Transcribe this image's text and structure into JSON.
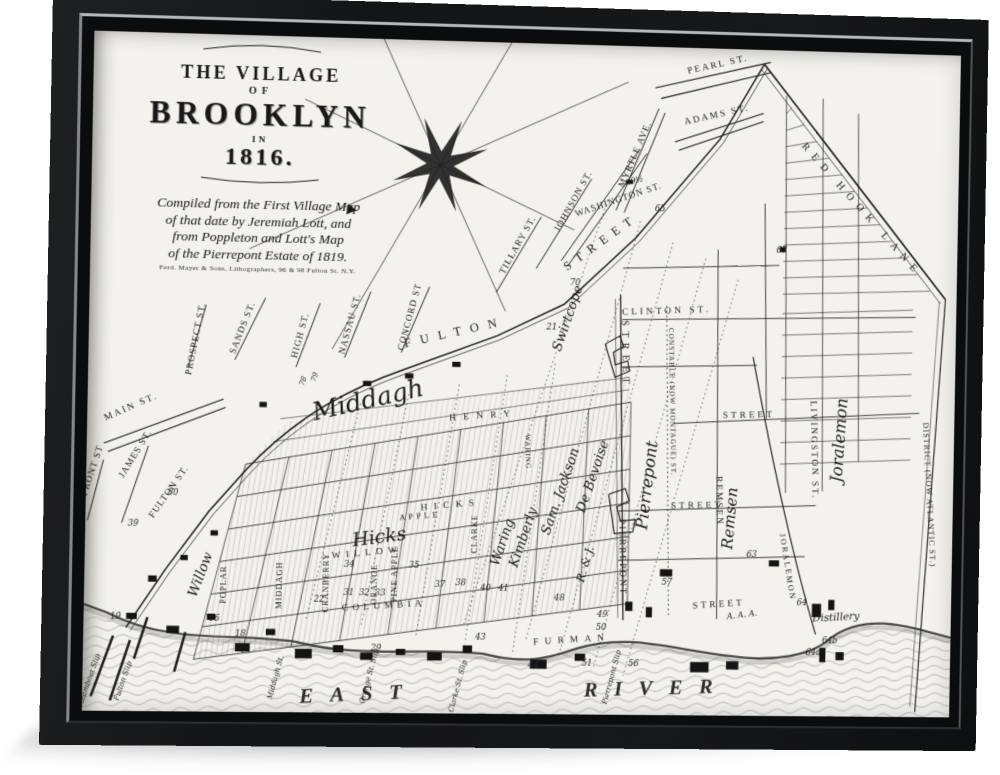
{
  "colors": {
    "frame": "#141517",
    "frame_lip": "#b6b8bb",
    "canvas": "#f3f2ed",
    "ink": "#1c1c1c",
    "water_line": "#8f8f8f"
  },
  "artwork": {
    "title_block": {
      "line1": "THE VILLAGE",
      "line2": "OF",
      "line3": "BROOKLYN",
      "line4": "IN",
      "line5": "1816.",
      "credit_lines": [
        "Compiled from the First Village Map",
        "of that date by Jeremiah Lott, and",
        "from Poppleton and Lott's Map",
        "of the Pierrepont Estate of 1819."
      ],
      "publisher": "Ferd. Mayer & Sons, Lithographers, 96 & 98 Fulton St. N.Y."
    }
  },
  "map": {
    "labels": [
      {
        "t": "PEARL ST.",
        "x": 597,
        "y": 18,
        "r": -14,
        "s": 9,
        "ls": 2
      },
      {
        "t": "ADAMS ST.",
        "x": 597,
        "y": 67,
        "r": -14,
        "s": 9,
        "ls": 2
      },
      {
        "t": "RED HOOK LANE",
        "x": 738,
        "y": 156,
        "r": 47,
        "s": 10,
        "ls": 7
      },
      {
        "t": "MYRTLE AVE.",
        "x": 520,
        "y": 106,
        "r": -68,
        "s": 9,
        "ls": 1
      },
      {
        "t": "WASHINGTON ST.",
        "x": 503,
        "y": 152,
        "r": -20,
        "s": 9,
        "ls": 1
      },
      {
        "t": "JOHNSON ST.",
        "x": 461,
        "y": 153,
        "r": -62,
        "s": 9,
        "ls": 1
      },
      {
        "t": "TILLARY ST.",
        "x": 408,
        "y": 197,
        "r": -62,
        "s": 9,
        "ls": 1
      },
      {
        "t": "CONCORD ST",
        "x": 306,
        "y": 268,
        "r": -76,
        "s": 9,
        "ls": 1
      },
      {
        "t": "NASSAU ST.",
        "x": 249,
        "y": 276,
        "r": -76,
        "s": 9,
        "ls": 1
      },
      {
        "t": "HIGH ST.",
        "x": 202,
        "y": 288,
        "r": -76,
        "s": 9,
        "ls": 1
      },
      {
        "t": "SANDS ST.",
        "x": 147,
        "y": 282,
        "r": -70,
        "s": 9,
        "ls": 1
      },
      {
        "t": "PROSPECT ST.",
        "x": 103,
        "y": 293,
        "r": -80,
        "s": 9,
        "ls": 1
      },
      {
        "t": "MAIN ST.",
        "x": 42,
        "y": 361,
        "r": -25,
        "s": 9,
        "ls": 2
      },
      {
        "t": "FRONT ST",
        "x": 8,
        "y": 421,
        "r": -73,
        "s": 9,
        "ls": 1
      },
      {
        "t": "JAMES ST.",
        "x": 48,
        "y": 405,
        "r": -60,
        "s": 9,
        "ls": 1
      },
      {
        "t": "FULTON ST.",
        "x": 80,
        "y": 441,
        "r": -56,
        "s": 9,
        "ls": 1
      },
      {
        "t": "FULTON",
        "x": 348,
        "y": 285,
        "r": -14,
        "s": 12,
        "ls": 9
      },
      {
        "t": "STREET",
        "x": 488,
        "y": 194,
        "r": -37,
        "s": 12,
        "ls": 7
      },
      {
        "t": "STREET",
        "x": 509,
        "y": 300,
        "r": 88,
        "s": 10,
        "ls": 5
      },
      {
        "t": "PIERREPONT",
        "x": 510,
        "y": 497,
        "r": 88,
        "s": 9,
        "ls": 2
      },
      {
        "t": "CLINTON ST.",
        "x": 551,
        "y": 259,
        "r": -3,
        "s": 9,
        "ls": 3
      },
      {
        "t": "CONSTABLE (NOW MONTAGUE) ST.",
        "x": 556,
        "y": 345,
        "r": 88,
        "s": 7,
        "ls": 1
      },
      {
        "t": "REMSEN",
        "x": 603,
        "y": 441,
        "r": 88,
        "s": 9,
        "ls": 2
      },
      {
        "t": "STREET",
        "x": 633,
        "y": 359,
        "r": -2,
        "s": 9,
        "ls": 3
      },
      {
        "t": "STREET",
        "x": 584,
        "y": 448,
        "r": -2,
        "s": 9,
        "ls": 3
      },
      {
        "t": "STREET",
        "x": 607,
        "y": 544,
        "r": -4,
        "s": 9,
        "ls": 3
      },
      {
        "t": "LIVINGSTON ST.",
        "x": 695,
        "y": 390,
        "r": 88,
        "s": 9,
        "ls": 2
      },
      {
        "t": "JORALEMON",
        "x": 671,
        "y": 505,
        "r": 80,
        "s": 8,
        "ls": 2
      },
      {
        "t": "DISTRICT (NOW ATLANTIC ST.)",
        "x": 809,
        "y": 432,
        "r": 86,
        "s": 8,
        "ls": 1
      },
      {
        "t": "HENRY",
        "x": 376,
        "y": 364,
        "r": -5,
        "s": 9,
        "ls": 7
      },
      {
        "t": "HICKS",
        "x": 346,
        "y": 451,
        "r": -6,
        "s": 9,
        "ls": 6
      },
      {
        "t": "APPLE",
        "x": 317,
        "y": 462,
        "r": -6,
        "s": 8,
        "ls": 3
      },
      {
        "t": "WILLOW",
        "x": 267,
        "y": 498,
        "r": -6,
        "s": 9,
        "ls": 5
      },
      {
        "t": "COLUMBIA",
        "x": 284,
        "y": 549,
        "r": -4,
        "s": 9,
        "ls": 4
      },
      {
        "t": "FURMAN",
        "x": 465,
        "y": 580,
        "r": -4,
        "s": 9,
        "ls": 6
      },
      {
        "t": "POPLAR",
        "x": 134,
        "y": 528,
        "r": -90,
        "s": 8,
        "ls": 1
      },
      {
        "t": "MIDDAGH",
        "x": 186,
        "y": 528,
        "r": -90,
        "s": 8,
        "ls": 1
      },
      {
        "t": "CRANBERRY",
        "x": 231,
        "y": 525,
        "r": -90,
        "s": 8,
        "ls": 1
      },
      {
        "t": "ORANGE",
        "x": 277,
        "y": 526,
        "r": -90,
        "s": 8,
        "ls": 1
      },
      {
        "t": "PINE APPLE",
        "x": 296,
        "y": 516,
        "r": -90,
        "s": 8,
        "ls": 1
      },
      {
        "t": "CLARKE",
        "x": 372,
        "y": 476,
        "r": -90,
        "s": 8,
        "ls": 1
      },
      {
        "t": "WARING",
        "x": 417,
        "y": 396,
        "r": 88,
        "s": 7,
        "ls": 1
      },
      {
        "t": "Middagh",
        "x": 267,
        "y": 356,
        "r": -14,
        "s": 24,
        "c": "cur"
      },
      {
        "t": "Hicks",
        "x": 279,
        "y": 486,
        "r": -8,
        "s": 18,
        "c": "cur"
      },
      {
        "t": "Willow",
        "x": 113,
        "y": 520,
        "r": -70,
        "s": 13,
        "c": "cur"
      },
      {
        "t": "Swirtcope",
        "x": 459,
        "y": 267,
        "r": -72,
        "s": 13,
        "c": "cur"
      },
      {
        "t": "Waring",
        "x": 400,
        "y": 485,
        "r": -72,
        "s": 13,
        "c": "cur"
      },
      {
        "t": "Kimberly",
        "x": 420,
        "y": 480,
        "r": -72,
        "s": 13,
        "c": "cur"
      },
      {
        "t": "Sam. Jackson",
        "x": 455,
        "y": 435,
        "r": -72,
        "s": 13,
        "c": "cur"
      },
      {
        "t": "De Bevoise",
        "x": 486,
        "y": 420,
        "r": -72,
        "s": 13,
        "c": "cur"
      },
      {
        "t": "R. & J.",
        "x": 480,
        "y": 505,
        "r": -75,
        "s": 11,
        "c": "cur"
      },
      {
        "t": "Pierrepont",
        "x": 540,
        "y": 427,
        "r": -84,
        "s": 16,
        "c": "cur"
      },
      {
        "t": "Remsen",
        "x": 621,
        "y": 458,
        "r": -86,
        "s": 15,
        "c": "cur"
      },
      {
        "t": "Joralemon",
        "x": 727,
        "y": 380,
        "r": -87,
        "s": 16,
        "c": "cur"
      },
      {
        "t": "Distillery",
        "x": 722,
        "y": 556,
        "r": -4,
        "s": 10,
        "c": "cur"
      },
      {
        "t": "A. A. A.",
        "x": 630,
        "y": 554,
        "r": -8,
        "s": 8,
        "c": "cur"
      },
      {
        "t": "Steamboat Slip",
        "x": 8,
        "y": 622,
        "r": -72,
        "s": 7,
        "c": "cur"
      },
      {
        "t": "Fulton Slip",
        "x": 40,
        "y": 622,
        "r": -72,
        "s": 7,
        "c": "cur"
      },
      {
        "t": "Middagh St.",
        "x": 184,
        "y": 617,
        "r": -76,
        "s": 7,
        "c": "cur"
      },
      {
        "t": "Orange St. Slip",
        "x": 273,
        "y": 615,
        "r": -76,
        "s": 7,
        "c": "cur"
      },
      {
        "t": "Clarke St. Slip",
        "x": 358,
        "y": 624,
        "r": -76,
        "s": 7,
        "c": "cur"
      },
      {
        "t": "Pierrepont Slip",
        "x": 506,
        "y": 614,
        "r": -76,
        "s": 7,
        "c": "cur"
      },
      {
        "t": "EAST",
        "x": 262,
        "y": 638,
        "r": -3,
        "s": 20,
        "ls": 16,
        "c": "big"
      },
      {
        "t": "RIVER",
        "x": 548,
        "y": 630,
        "r": -2,
        "s": 20,
        "ls": 16,
        "c": "big"
      },
      {
        "t": "19",
        "x": 30,
        "y": 562,
        "s": 8,
        "c": "num"
      },
      {
        "t": "39",
        "x": 45,
        "y": 473,
        "s": 8,
        "c": "num"
      },
      {
        "t": "80",
        "x": 82,
        "y": 443,
        "s": 8,
        "c": "num"
      },
      {
        "t": "78",
        "x": 205,
        "y": 332,
        "r": -70,
        "s": 7,
        "c": "num"
      },
      {
        "t": "79",
        "x": 216,
        "y": 328,
        "r": -70,
        "s": 7,
        "c": "num"
      },
      {
        "t": "70",
        "x": 462,
        "y": 233,
        "s": 8,
        "c": "num"
      },
      {
        "t": "21",
        "x": 440,
        "y": 277,
        "s": 8,
        "c": "num"
      },
      {
        "t": "65",
        "x": 543,
        "y": 160,
        "s": 8,
        "c": "num"
      },
      {
        "t": "67",
        "x": 662,
        "y": 198,
        "s": 8,
        "c": "num"
      },
      {
        "t": "69½",
        "x": 518,
        "y": 133,
        "r": -15,
        "s": 8,
        "c": "num"
      },
      {
        "t": "57",
        "x": 556,
        "y": 523,
        "s": 8,
        "c": "num"
      },
      {
        "t": "63",
        "x": 638,
        "y": 495,
        "s": 8,
        "c": "num"
      },
      {
        "t": "64",
        "x": 688,
        "y": 542,
        "s": 8,
        "c": "num"
      },
      {
        "t": "64a",
        "x": 700,
        "y": 590,
        "s": 8,
        "c": "num"
      },
      {
        "t": "64b",
        "x": 716,
        "y": 578,
        "s": 8,
        "c": "num"
      },
      {
        "t": "48",
        "x": 452,
        "y": 540,
        "s": 8,
        "c": "num"
      },
      {
        "t": "49",
        "x": 494,
        "y": 555,
        "s": 8,
        "c": "num"
      },
      {
        "t": "50",
        "x": 493,
        "y": 568,
        "s": 8,
        "c": "num"
      },
      {
        "t": "40",
        "x": 381,
        "y": 531,
        "s": 8,
        "c": "num"
      },
      {
        "t": "41",
        "x": 398,
        "y": 531,
        "s": 8,
        "c": "num"
      },
      {
        "t": "43",
        "x": 377,
        "y": 578,
        "s": 8,
        "c": "num"
      },
      {
        "t": "34",
        "x": 250,
        "y": 510,
        "s": 8,
        "c": "num"
      },
      {
        "t": "35",
        "x": 312,
        "y": 510,
        "s": 8,
        "c": "num"
      },
      {
        "t": "37",
        "x": 337,
        "y": 528,
        "s": 8,
        "c": "num"
      },
      {
        "t": "38",
        "x": 357,
        "y": 526,
        "s": 8,
        "c": "num"
      },
      {
        "t": "31",
        "x": 250,
        "y": 537,
        "s": 8,
        "c": "num"
      },
      {
        "t": "32",
        "x": 265,
        "y": 537,
        "s": 8,
        "c": "num"
      },
      {
        "t": "33",
        "x": 280,
        "y": 537,
        "s": 8,
        "c": "num"
      },
      {
        "t": "22",
        "x": 222,
        "y": 543,
        "s": 8,
        "c": "num"
      },
      {
        "t": "29",
        "x": 277,
        "y": 590,
        "s": 8,
        "c": "num"
      },
      {
        "t": "44",
        "x": 428,
        "y": 605,
        "s": 8,
        "c": "num"
      },
      {
        "t": "51",
        "x": 480,
        "y": 603,
        "s": 8,
        "c": "num"
      },
      {
        "t": "56",
        "x": 525,
        "y": 603,
        "s": 8,
        "c": "num"
      },
      {
        "t": "18",
        "x": 148,
        "y": 577,
        "s": 8,
        "c": "num"
      },
      {
        "t": "16",
        "x": 123,
        "y": 563,
        "s": 8,
        "c": "num"
      }
    ],
    "buildings": [
      [
        40,
        556,
        10,
        6
      ],
      [
        78,
        568,
        12,
        7
      ],
      [
        116,
        556,
        8,
        6
      ],
      [
        143,
        584,
        14,
        8
      ],
      [
        172,
        570,
        9,
        6
      ],
      [
        200,
        589,
        16,
        9
      ],
      [
        236,
        585,
        10,
        7
      ],
      [
        262,
        592,
        12,
        7
      ],
      [
        296,
        588,
        9,
        6
      ],
      [
        326,
        591,
        14,
        8
      ],
      [
        360,
        584,
        9,
        7
      ],
      [
        425,
        597,
        16,
        9
      ],
      [
        468,
        591,
        10,
        7
      ],
      [
        516,
        540,
        7,
        9
      ],
      [
        536,
        545,
        6,
        10
      ],
      [
        580,
        598,
        18,
        10
      ],
      [
        615,
        597,
        12,
        8
      ],
      [
        698,
        540,
        9,
        13
      ],
      [
        714,
        536,
        6,
        10
      ],
      [
        706,
        583,
        6,
        14
      ],
      [
        722,
        587,
        8,
        8
      ],
      [
        655,
        498,
        10,
        6
      ],
      [
        549,
        508,
        12,
        7
      ],
      [
        60,
        520,
        8,
        6
      ],
      [
        90,
        500,
        7,
        5
      ],
      [
        118,
        476,
        7,
        5
      ],
      [
        260,
        330,
        8,
        5
      ],
      [
        300,
        322,
        8,
        5
      ],
      [
        345,
        310,
        8,
        5
      ],
      [
        162,
        352,
        7,
        5
      ],
      [
        660,
        192,
        6,
        5
      ],
      [
        510,
        130,
        6,
        4
      ]
    ]
  }
}
